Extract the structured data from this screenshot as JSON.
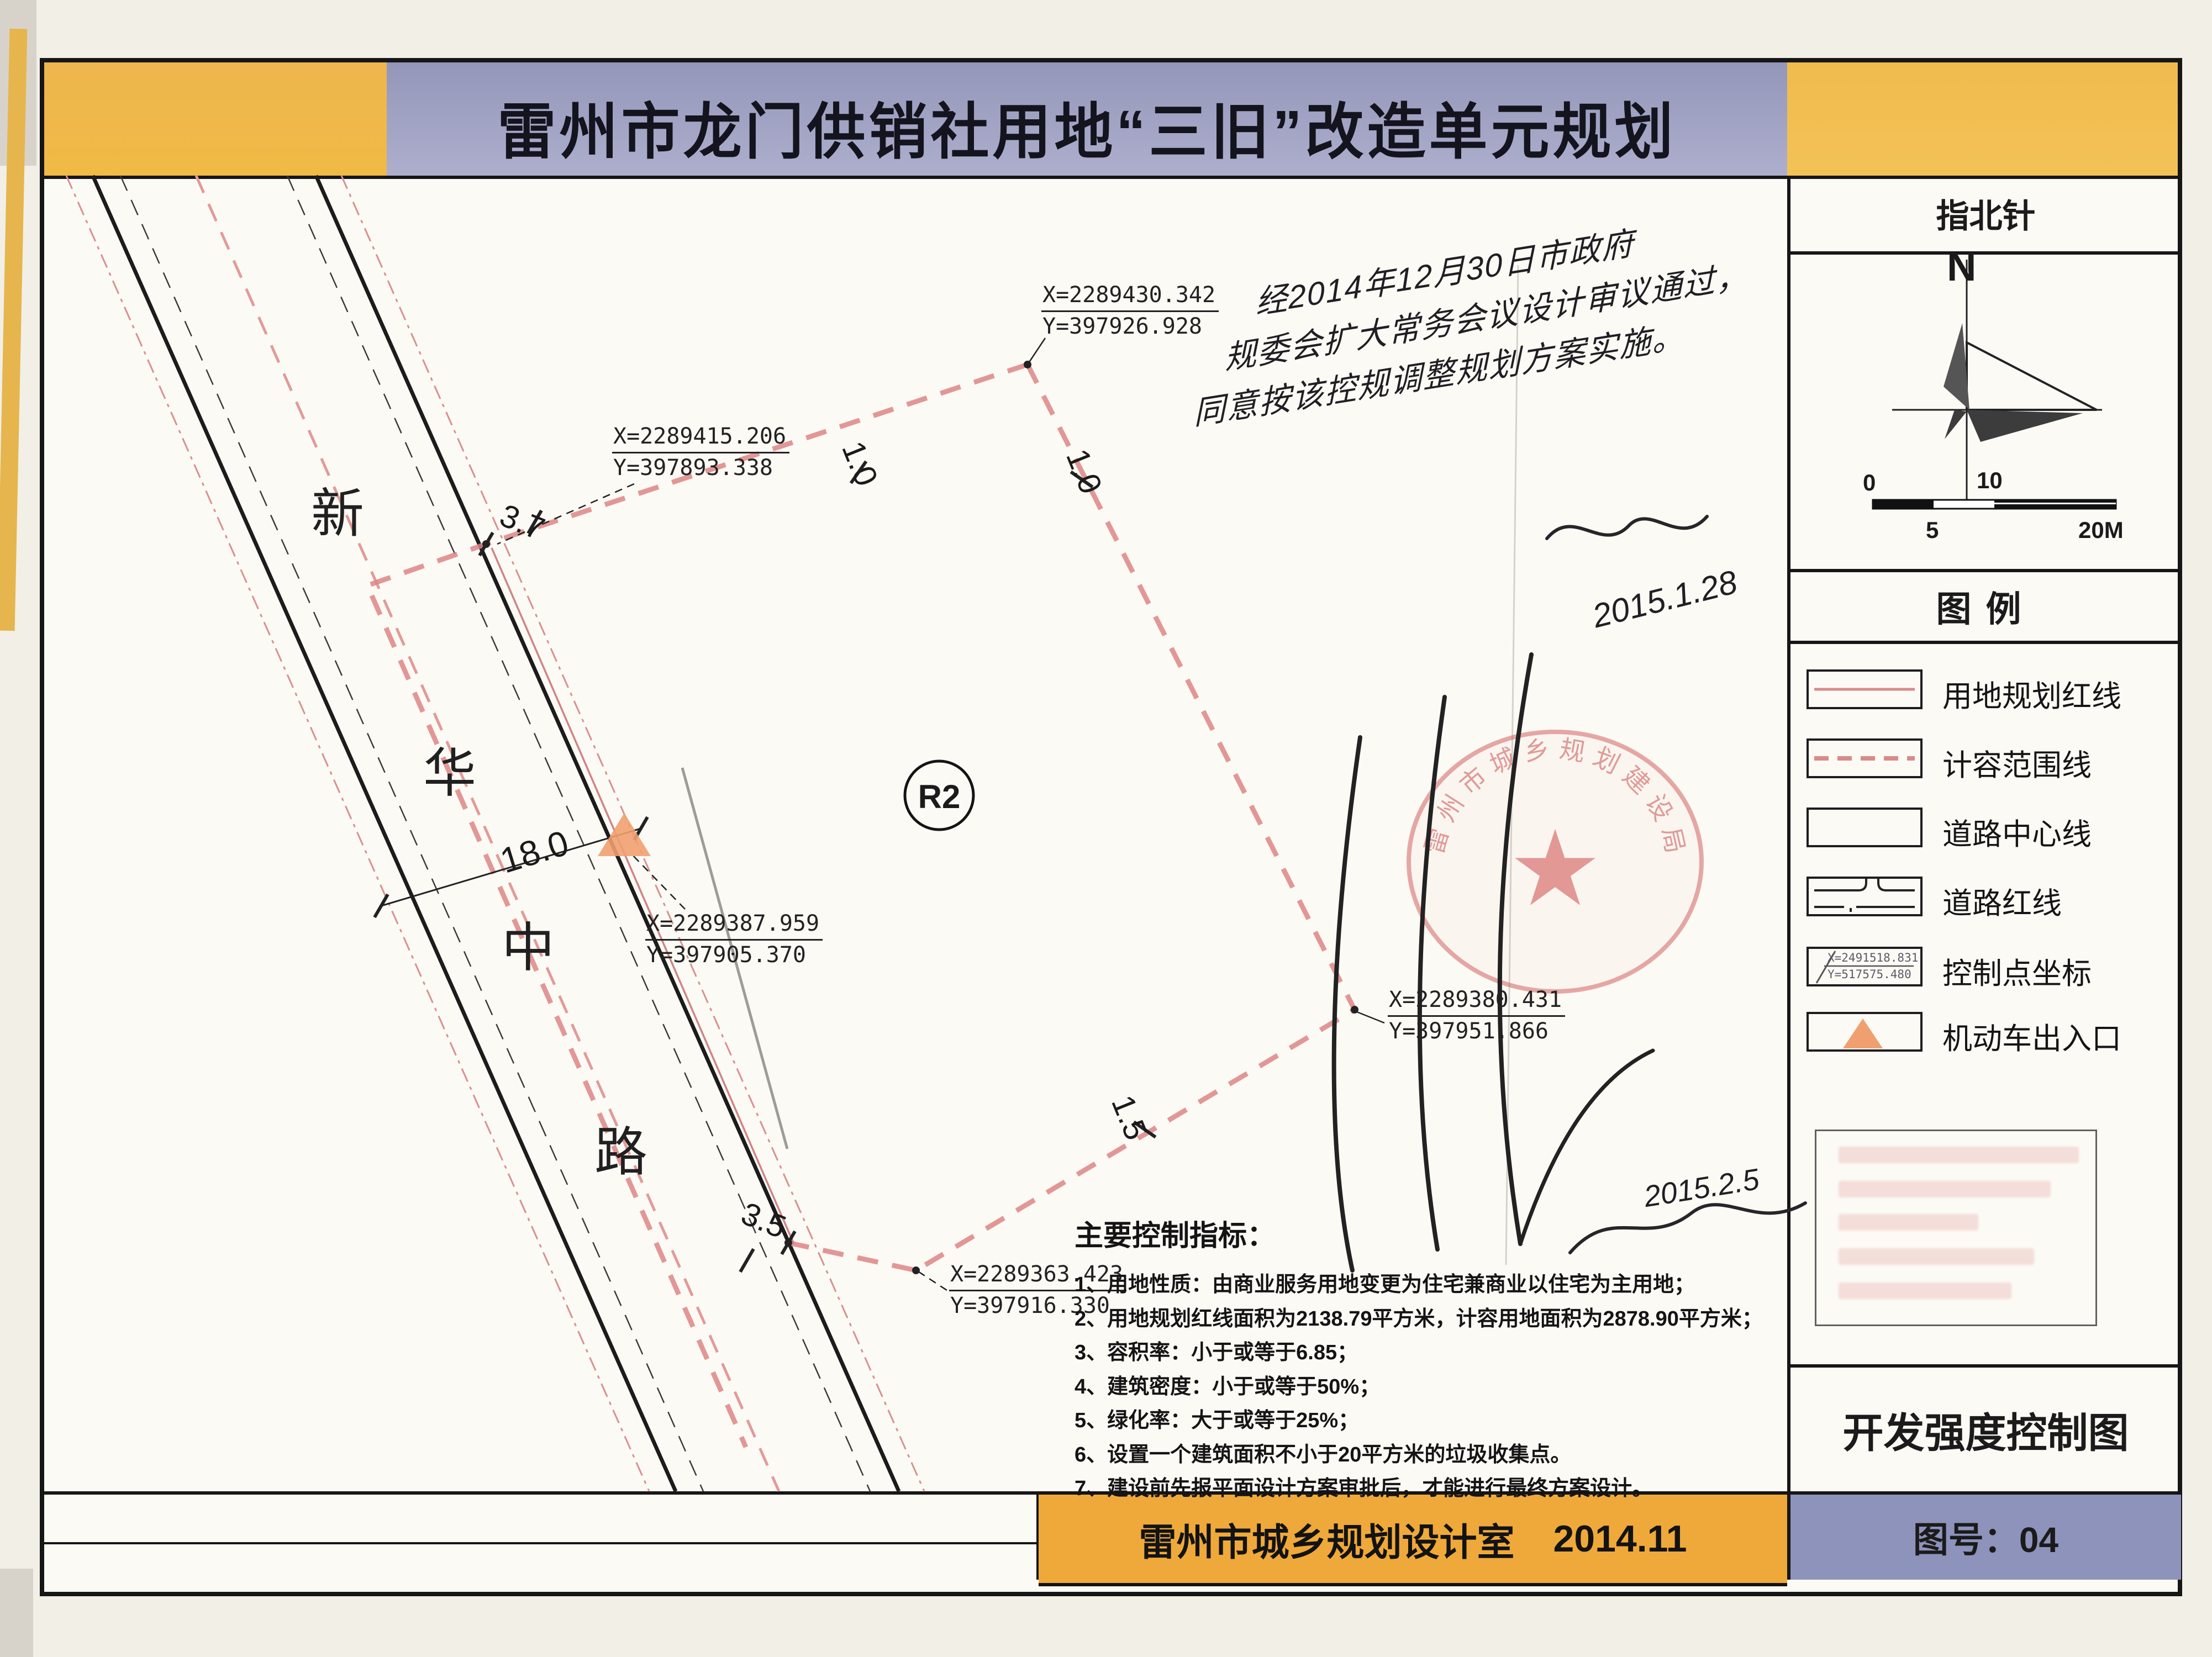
{
  "title": "雷州市龙门供销社用地“三旧”改造单元规划",
  "sidebar": {
    "compass_header": "指北针",
    "legend_header": "图例",
    "drawing_title": "开发强度控制图",
    "sheet_no": "图号：04"
  },
  "compass": {
    "north": "N",
    "scale": [
      "0",
      "5",
      "10",
      "20M"
    ]
  },
  "legend": {
    "items": [
      {
        "label": "用地规划红线"
      },
      {
        "label": "计容范围线"
      },
      {
        "label": "道路中心线"
      },
      {
        "label": "道路红线"
      },
      {
        "label": "控制点坐标"
      },
      {
        "label": "机动车出入口"
      }
    ],
    "coord_sample": {
      "x": "X=2491518.831",
      "y": "Y=517575.480"
    }
  },
  "road": {
    "name": [
      "新",
      "华",
      "中",
      "路"
    ],
    "width_label": "18.0"
  },
  "zone_label": "R2",
  "dims": {
    "offset_top": "3.7",
    "offset_bottom": "3.5",
    "seg_small": "1.0",
    "seg_right": "1.5"
  },
  "coords": [
    {
      "x": "X=2289430.342",
      "y": "Y=397926.928"
    },
    {
      "x": "X=2289415.206",
      "y": "Y=397893.338"
    },
    {
      "x": "X=2289387.959",
      "y": "Y=397905.370"
    },
    {
      "x": "X=2289380.431",
      "y": "Y=397951.866"
    },
    {
      "x": "X=2289363.423",
      "y": "Y=397916.330"
    }
  ],
  "indicators": {
    "heading": "主要控制指标：",
    "items": [
      "1、用地性质：由商业服务用地变更为住宅兼商业以住宅为主用地；",
      "2、用地规划红线面积为2138.79平方米，计容用地面积为2878.90平方米；",
      "3、容积率：小于或等于6.85；",
      "4、建筑密度：小于或等于50%；",
      "5、绿化率：大于或等于25%；",
      "6、设置一个建筑面积不小于20平方米的垃圾收集点。",
      "7、建设前先报平面设计方案审批后，才能进行最终方案设计。"
    ]
  },
  "handwriting": {
    "note": [
      "经2014年12月30日市政府",
      "规委会扩大常务会议设计审议通过，",
      "同意按该控规调整规划方案实施。"
    ],
    "date1": "2015.1.28",
    "date2": "2015.2.5"
  },
  "stamp": {
    "arc_text": "雷州市城乡规划建设局",
    "star": "★"
  },
  "footer": {
    "org": "雷州市城乡规划设计室",
    "date": "2014.11"
  },
  "colors": {
    "band_orange": "#efb049",
    "band_violet": "#a2a4c8",
    "bar_violet": "#8d93bb",
    "parcel_red": "#dd8585",
    "stamp_red": "#cf7b7b",
    "entrance_orange": "#f0a070"
  }
}
